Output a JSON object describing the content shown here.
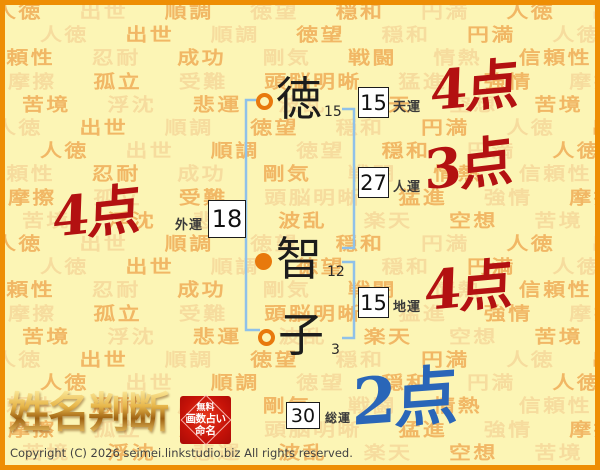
{
  "window": {
    "copyright": "Copyright (C) 2026 seimei.linkstudio.biz All rights reserved."
  },
  "logo": {
    "title": "姓名判断",
    "seal": {
      "line1": "無料",
      "line2": "画数占い",
      "line3": "命名"
    }
  },
  "name": {
    "chars": [
      {
        "glyph": "徳",
        "strokes": "15",
        "marker": "ring"
      },
      {
        "glyph": "智",
        "strokes": "12",
        "marker": "dot"
      },
      {
        "glyph": "子",
        "strokes": "3",
        "marker": "ring"
      }
    ]
  },
  "fortunes": {
    "ten": {
      "label": "天運",
      "value": "15",
      "score": "4点"
    },
    "jin": {
      "label": "人運",
      "value": "27",
      "score": "3点"
    },
    "gai": {
      "label": "外運",
      "value": "18",
      "score": "4点"
    },
    "chi": {
      "label": "地運",
      "value": "15",
      "score": "4点"
    },
    "sou": {
      "label": "総運",
      "value": "30",
      "score": "2点"
    }
  },
  "colors": {
    "accent_orange": "#EE8E04",
    "bracket_blue": "#8FC1E9",
    "marker_orange": "#E8790D",
    "score_red": "#B31111",
    "score_blue": "#2A66B8"
  },
  "background": {
    "row_count": 20,
    "rows": [
      "人徳 出世 順調 徳望 穏和 円満 人徳 出世 順調",
      "人徳 出世 順調 徳望 穏和 円満 人徳 出世 順調",
      "信頼性 忍耐 成功 剛気 戦闘 情熱 信頼性 忍耐",
      "摩擦 孤立 受難 頭脳明晰 猛進 強情 摩擦 孤立",
      "苦境 浮沈 悲運 波乱 楽天 空想 苦境 浮沈 悲運"
    ]
  }
}
